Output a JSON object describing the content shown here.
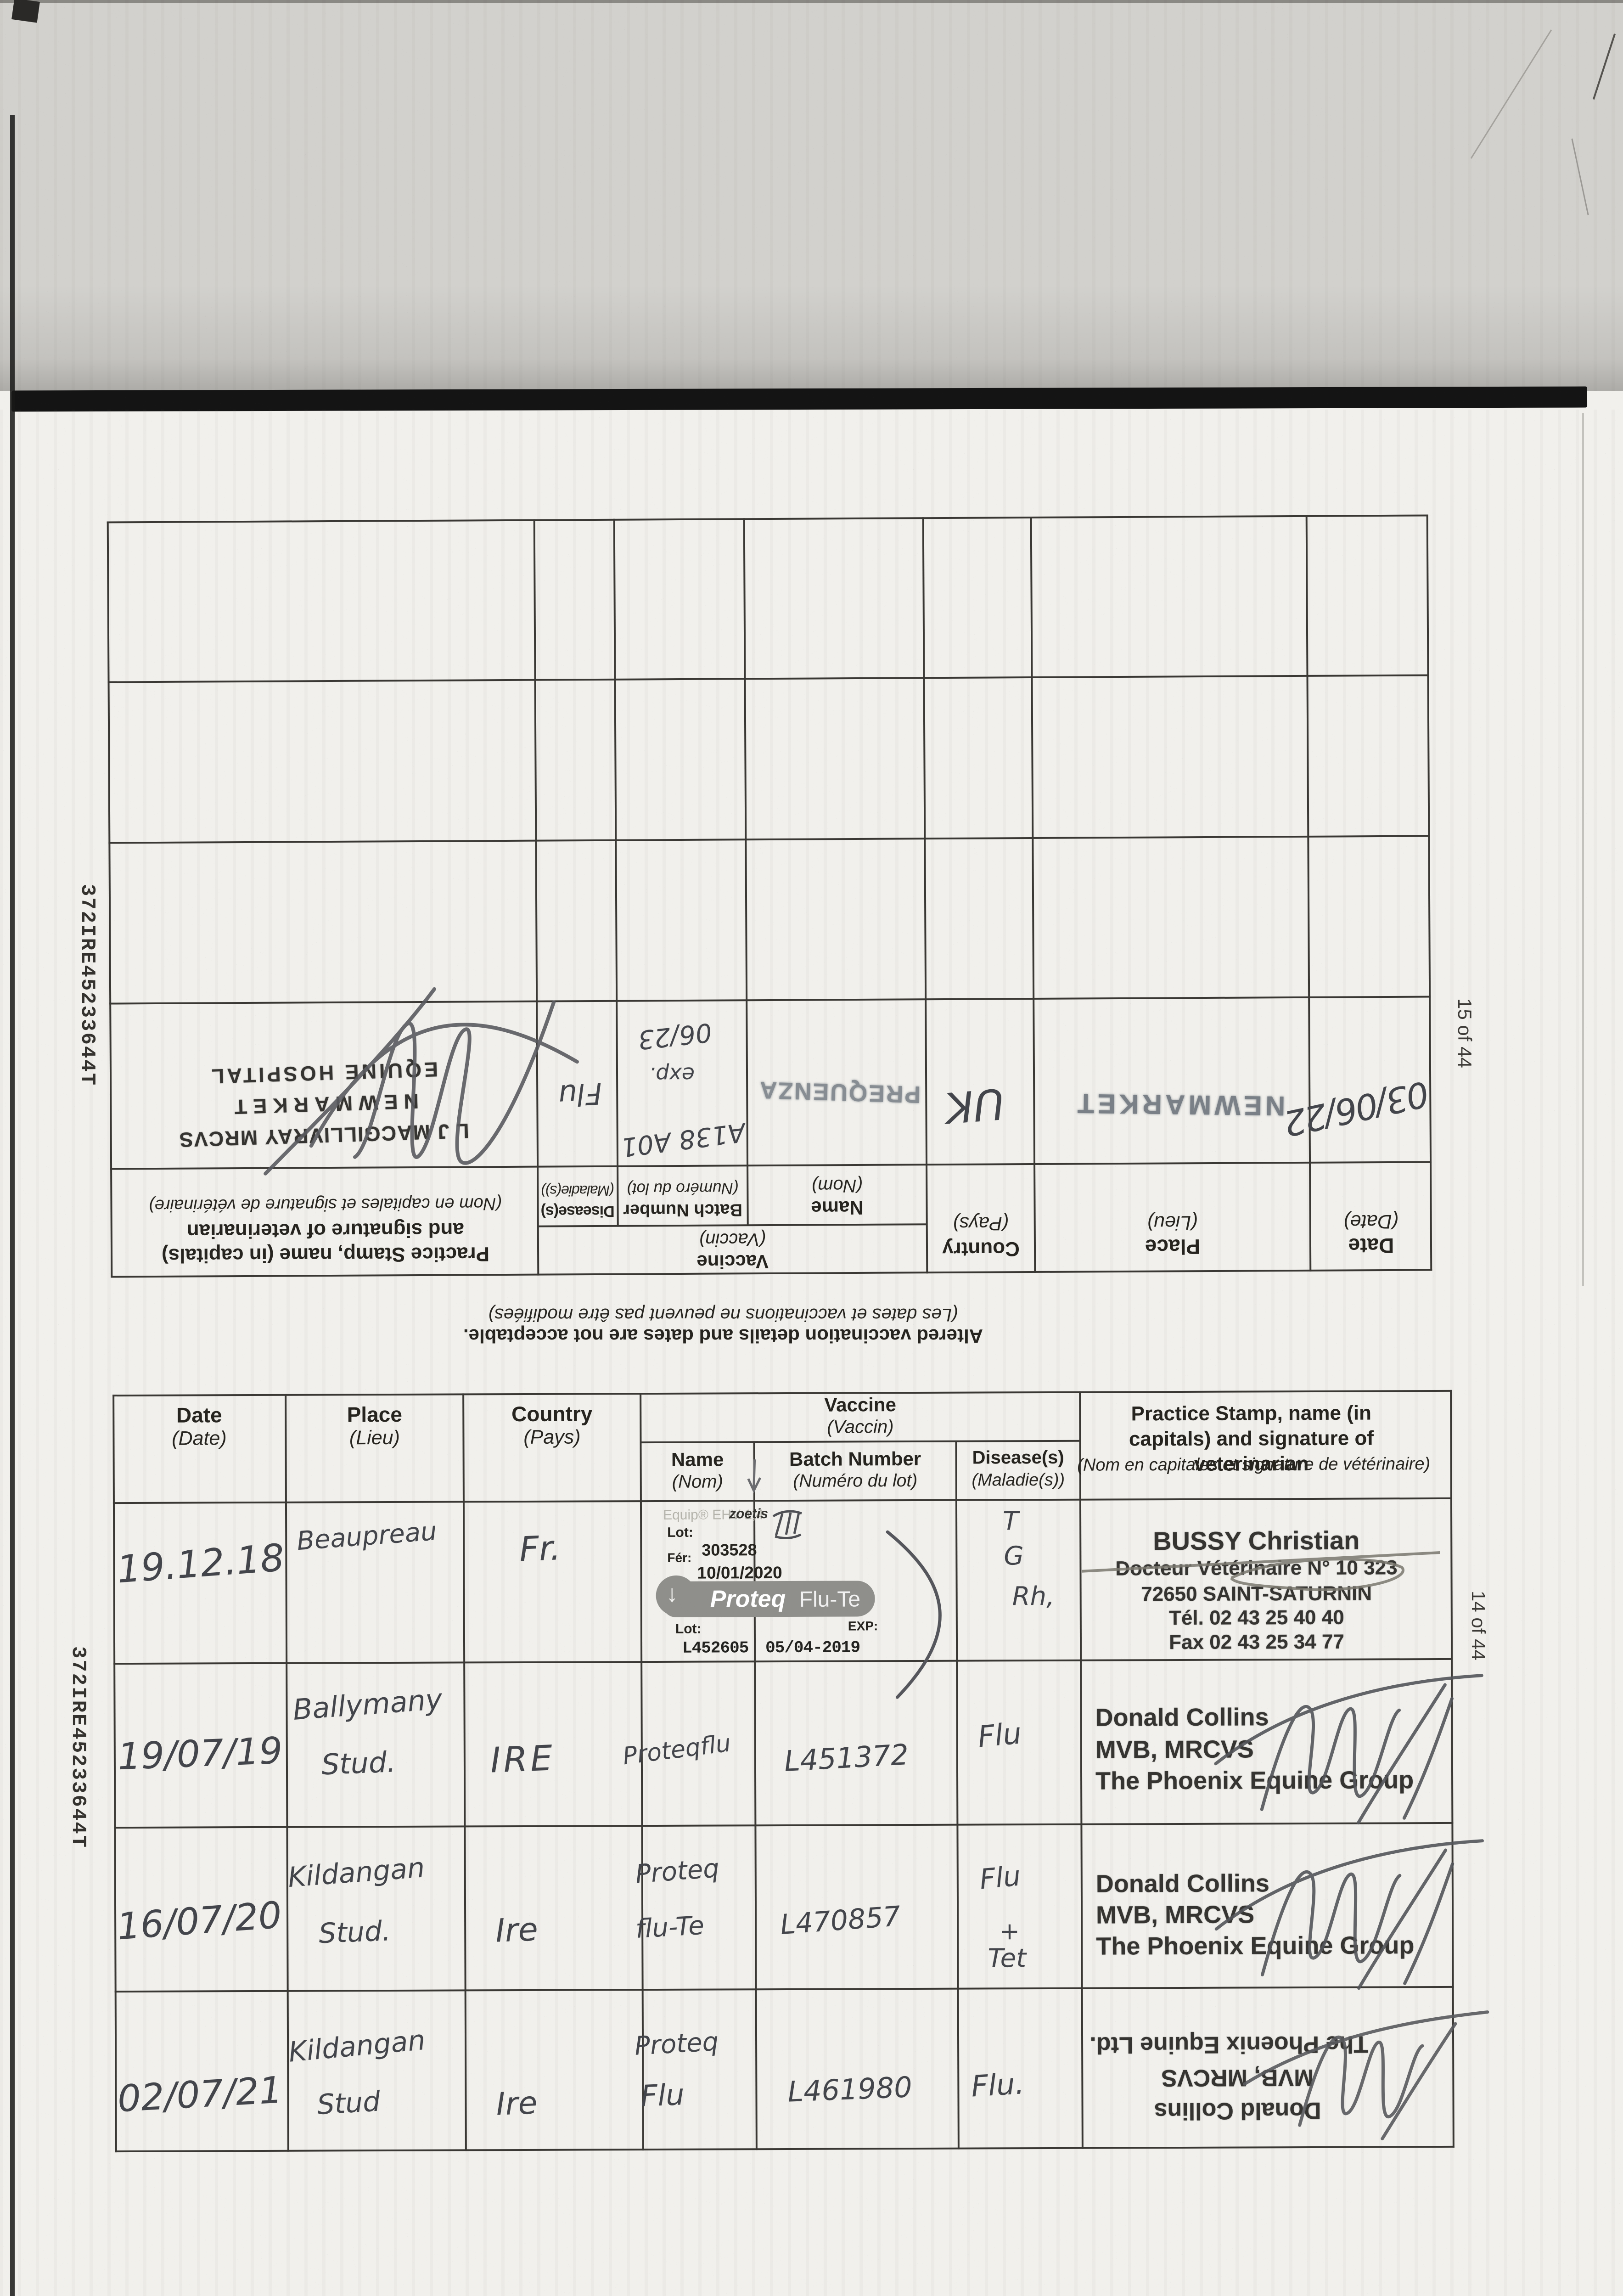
{
  "document": {
    "code_label": "372IRE45233644T",
    "page_number_top": "15 of 44",
    "page_number_bottom": "14 of 44",
    "warning_en": "Altered vaccination details and dates are not acceptable.",
    "warning_fr": "(Les dates et vaccinations ne peuvent pas être modifiées)"
  },
  "headers": {
    "date_en": "Date",
    "date_fr": "(Date)",
    "place_en": "Place",
    "place_fr": "(Lieu)",
    "country_en": "Country",
    "country_fr": "(Pays)",
    "vaccine_en": "Vaccine",
    "vaccine_fr": "(Vaccin)",
    "name_en": "Name",
    "name_fr": "(Nom)",
    "batch_en": "Batch Number",
    "batch_fr": "(Numéro du lot)",
    "disease_en": "Disease(s)",
    "disease_fr": "(Maladie(s))",
    "stamp_en": "Practice Stamp, name (in capitals) and signature of veterinarian",
    "stamp_fr": "(Nom en capitales et signature de vétérinaire)"
  },
  "top_table": {
    "row": {
      "date": "03/06/22",
      "place_stamp": "NEWMARKET",
      "country": "UK",
      "name_stamp": "PREQUENZA",
      "batch_line1": "A138 A01",
      "batch_line2": "exp.",
      "batch_line3": "06/23",
      "disease": "Flu",
      "stamp": [
        "L J MACGILLIVRAY MRCVS",
        "NEWMARKET",
        "EQUINE HOSPITAL"
      ]
    }
  },
  "bottom_table": {
    "rows": [
      {
        "date": "19.12.18",
        "place": "Beaupreau",
        "country": "Fr.",
        "sticker": {
          "brand_top": "Equip® EHV 1,4",
          "zoetis": "zoetis",
          "lot_label": "Lot:",
          "lot_value": "303528",
          "fer_label": "Fér:",
          "date_value": "10/01/2020",
          "product_bold": "Proteq",
          "product_light": "Flu-Te",
          "lot2_label": "Lot:",
          "lot2_value": "L452605",
          "exp_label": "EXP:",
          "exp_value": "05/04-2019"
        },
        "diseases": [
          "T",
          "G",
          "Rh,"
        ],
        "stamp": [
          "BUSSY Christian",
          "Docteur Vétérinaire N° 10 323",
          "72650 SAINT-SATURNIN",
          "Tél. 02 43 25 40 40",
          "Fax 02 43 25 34 77"
        ]
      },
      {
        "date": "19/07/19",
        "place_line1": "Ballymany",
        "place_line2": "Stud.",
        "country": "IRE",
        "name": "Proteqflu",
        "batch": "L451372",
        "disease": "Flu",
        "stamp": [
          "Donald Collins",
          "MVB, MRCVS",
          "The Phoenix Equine Group"
        ]
      },
      {
        "date": "16/07/20",
        "place_line1": "Kildangan",
        "place_line2": "Stud.",
        "country": "Ire",
        "name_line1": "Proteq",
        "name_line2": "flu-Te",
        "batch": "L470857",
        "disease_line1": "Flu",
        "disease_line2": "+",
        "disease_line3": "Tet",
        "stamp": [
          "Donald Collins",
          "MVB, MRCVS",
          "The Phoenix Equine Group"
        ]
      },
      {
        "date": "02/07/21",
        "place_line1": "Kildangan",
        "place_line2": "Stud",
        "country": "Ire",
        "name_line1": "Proteq",
        "name_line2": "Flu",
        "batch": "L461980",
        "disease": "Flu.",
        "stamp": [
          "Donald Collins",
          "MVB, MRCVS",
          "The Phoenix Equine Ltd."
        ]
      }
    ]
  },
  "colors": {
    "sticker_gray": "#8f8f8b",
    "stamp_ink_blue": "#7a8087",
    "stamp_print_dark": "#353431",
    "pencil": "#4a4c52",
    "paper": "#f1f0ec",
    "top_band": "#d2d1cd",
    "separator_bar": "#141414"
  }
}
